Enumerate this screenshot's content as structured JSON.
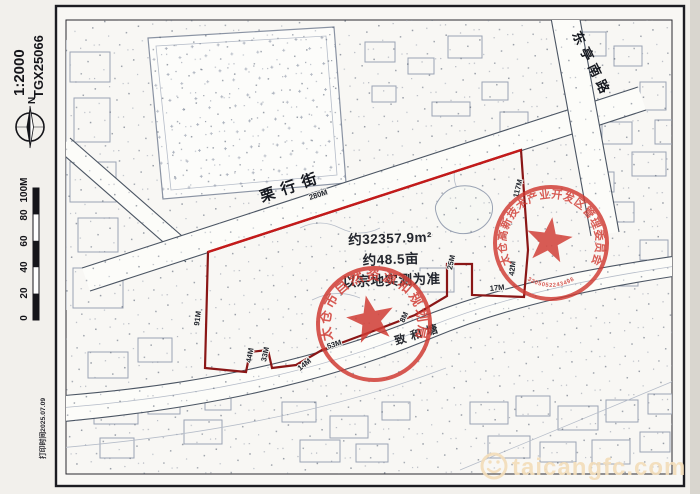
{
  "margin": {
    "scale_label": "1:2000",
    "sheet_number": "TGX25066",
    "north_label": "N",
    "scale_bar_ticks": [
      "100M",
      "80",
      "60",
      "40",
      "20",
      "0"
    ],
    "print_time": "打印时间2025.07.09"
  },
  "map": {
    "street_name": "栗行街",
    "road_name": "东亭南路",
    "river_name": "致和塘",
    "area_text": {
      "line1": "约32357.9m²",
      "line2": "约48.5亩",
      "line3": "以宗地实测为准"
    },
    "dimension_labels": [
      "280M",
      "117M",
      "42M",
      "25M",
      "17M",
      "8M",
      "53M",
      "14M",
      "33M",
      "44M",
      "91M"
    ]
  },
  "stamps": [
    {
      "arc_text": "太仓市自然资源和规划局"
    },
    {
      "arc_text": "太仓高新技术产业开发区管理委员会",
      "serial_number": "3205052243498"
    }
  ],
  "watermark": {
    "icon": "smiley-icon",
    "site_text": "taicangfc.com"
  },
  "colors": {
    "boundary_red": "#8a1616",
    "street_red": "#c41a1a",
    "stamp_red": "#d03a32",
    "watermark": "#f3ddba"
  }
}
